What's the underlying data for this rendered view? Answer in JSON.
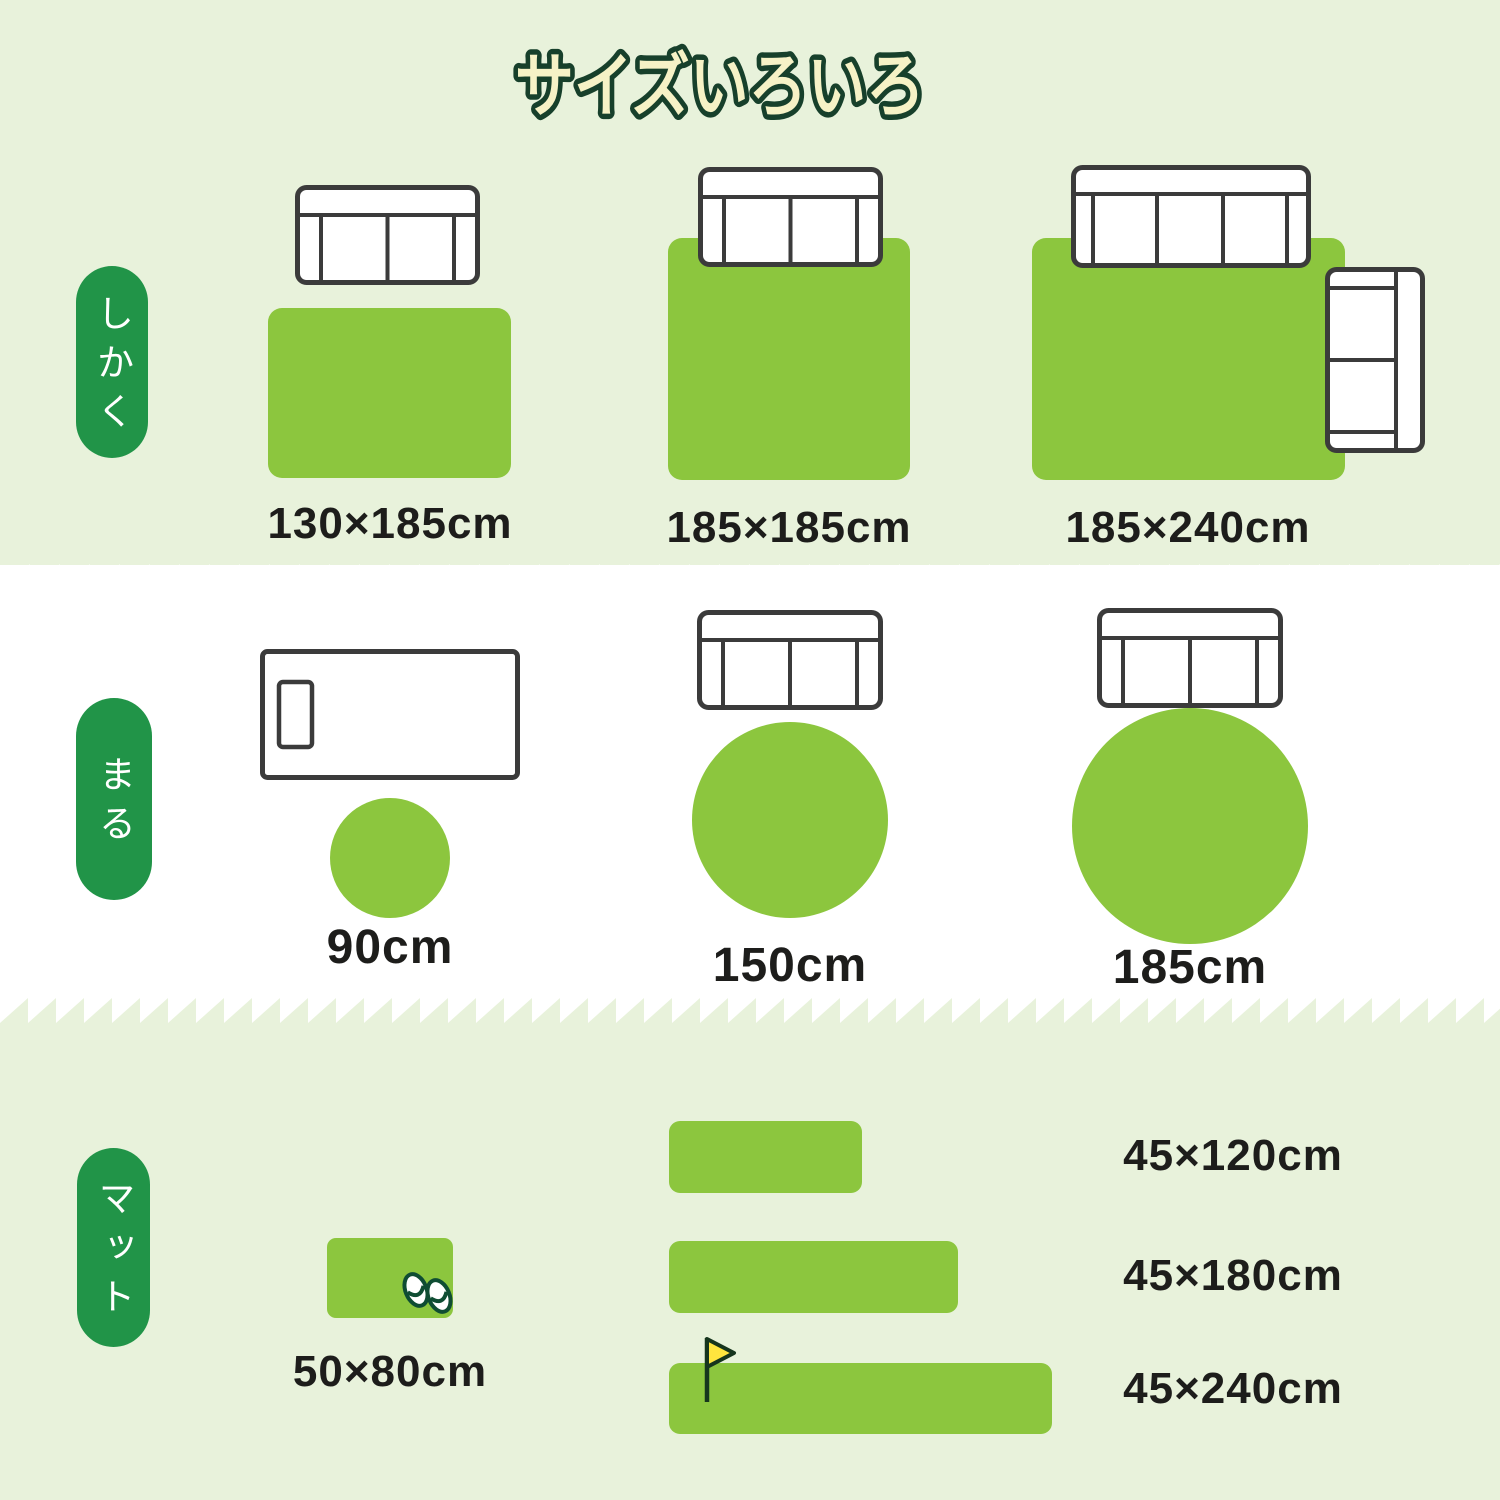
{
  "title": "サイズいろいろ",
  "colors": {
    "background_light_green": "#e8f2db",
    "background_white": "#ffffff",
    "rug_green": "#8cc63e",
    "pill_green": "#219448",
    "title_fill": "#f6f2c6",
    "title_outline": "#17402b",
    "label_text": "#1d1d1b",
    "furniture_outline": "#3b3b3b",
    "flag_yellow": "#ffe53e",
    "slipper_outline": "#0f4d33"
  },
  "sections": {
    "shikaku": {
      "label": "しかく",
      "items": [
        {
          "size": "130×185cm"
        },
        {
          "size": "185×185cm"
        },
        {
          "size": "185×240cm"
        }
      ]
    },
    "maru": {
      "label": "まる",
      "items": [
        {
          "size": "90cm"
        },
        {
          "size": "150cm"
        },
        {
          "size": "185cm"
        }
      ]
    },
    "mat": {
      "label": "マット",
      "items": [
        {
          "size": "50×80cm"
        },
        {
          "size": "45×120cm"
        },
        {
          "size": "45×180cm"
        },
        {
          "size": "45×240cm"
        }
      ]
    }
  }
}
